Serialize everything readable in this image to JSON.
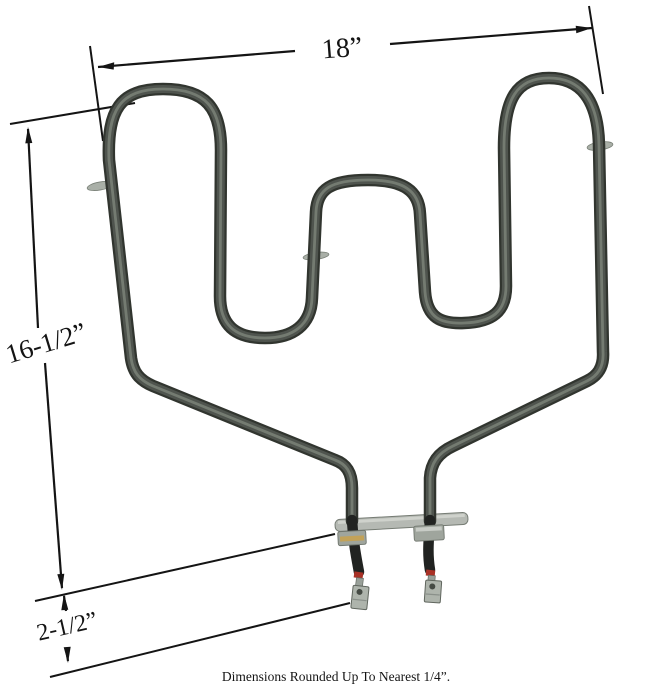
{
  "labels": {
    "top_width": "18”",
    "left_height": "16-1/2”",
    "terminal_offset": "2-1/2”"
  },
  "footnote": "Dimensions Rounded Up To Nearest 1/4”.",
  "colors": {
    "dimension_lines": "#141414",
    "label_text": "#141414",
    "tube_outline": "#31352f",
    "tube_body": "#4f544e",
    "tube_highlight": "#788076",
    "bracket_plate": "#b5b9b3",
    "bracket_edge": "#767c74",
    "nut_metal": "#9fa59d",
    "brass_band": "#c2a258",
    "lead_insulation": "#212321",
    "terminal_metal": "#aeb4ac",
    "terminal_edge": "#60665e",
    "red_band": "#a93126",
    "clip_metal": "#a9afa7"
  }
}
